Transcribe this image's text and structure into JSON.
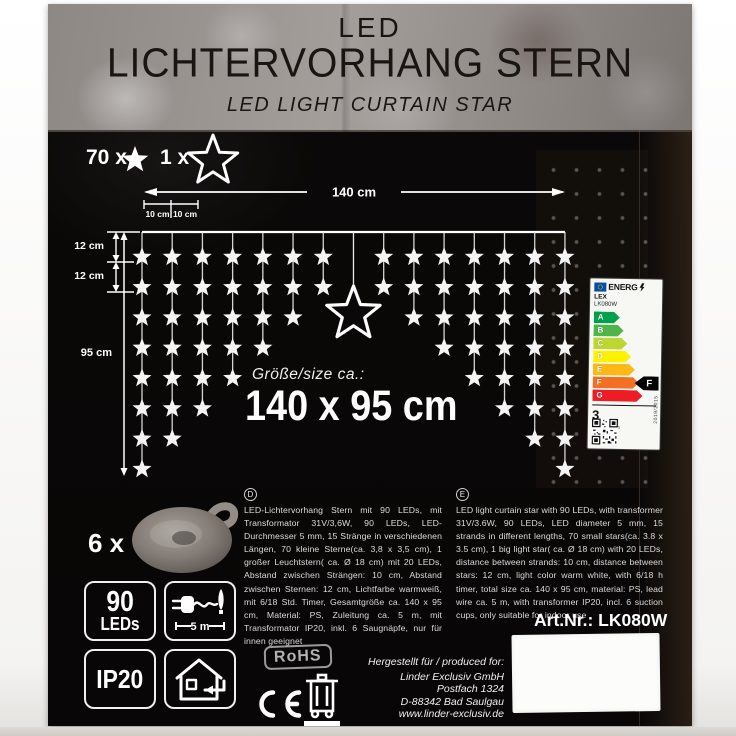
{
  "header": {
    "brand": "LED",
    "title": "LICHTERVORHANG STERN",
    "subtitle": "LED LIGHT CURTAIN STAR"
  },
  "counts": {
    "small_stars": "70 x",
    "big_star": "1 x"
  },
  "diagram": {
    "total_width_label": "140 cm",
    "strand_gap_label_1": "10 cm",
    "strand_gap_label_2": "10 cm",
    "first_gap_label": "12 cm",
    "star_gap_label": "12 cm",
    "total_height_label": "95 cm",
    "strand_star_counts": [
      8,
      7,
      6,
      5,
      4,
      3,
      2,
      0,
      2,
      3,
      4,
      5,
      6,
      7,
      8
    ],
    "big_star_strand_index": 7
  },
  "size_callout": {
    "label": "Größe/size ca.:",
    "value": "140 x 95 cm"
  },
  "energy_label": {
    "header": "ENERG",
    "brand": "LEX",
    "model": "LK080W",
    "classes": [
      {
        "letter": "A",
        "color": "#00a14b"
      },
      {
        "letter": "B",
        "color": "#4fb548"
      },
      {
        "letter": "C",
        "color": "#bed630"
      },
      {
        "letter": "D",
        "color": "#fff200"
      },
      {
        "letter": "E",
        "color": "#fcb814"
      },
      {
        "letter": "F",
        "color": "#f36f21"
      },
      {
        "letter": "G",
        "color": "#ee1c25"
      }
    ],
    "rating": "F",
    "rating_index": 5,
    "consumption_value": "3",
    "consumption_unit": "kWh/1000h",
    "side_text": "2019/2015"
  },
  "suction_cups": {
    "count": "6 x"
  },
  "description_de": {
    "marker": "D",
    "text": "LED-Lichtervorhang Stern mit 90 LEDs, mit Transformator 31V/3,6W, 90 LEDs, LED-Durchmesser 5 mm, 15 Stränge in verschiedenen Längen, 70 kleine Sterne(ca. 3,8 x 3,5 cm), 1 großer Leuchtstern( ca. Ø 18 cm) mit 20 LEDs, Abstand zwischen Strängen: 10 cm, Abstand zwischen Sternen: 12 cm, Lichtfarbe warmweiß, mit 6/18 Std. Timer, Gesamtgröße ca. 140 x 95 cm, Material: PS, Zuleitung ca. 5 m, mit Transformator IP20, inkl. 6 Saugnäpfe, nur für innen geeignet"
  },
  "description_en": {
    "marker": "E",
    "text": "LED light curtain star with 90 LEDs, with transformer 31V/3.6W, 90 LEDs, LED diameter 5 mm, 15 strands in different lengths, 70 small stars(ca. 3.8 x 3.5 cm), 1 big light star( ca. Ø 18 cm) with 20 LEDs, distance between strands: 10 cm, distance between stars: 12 cm, light color warm white, with 6/18 h timer, total size ca. 140 x 95 cm, material: PS, lead wire ca. 5 m, with transformer IP20, incl. 6 suction cups, only suitable for indoor use"
  },
  "badges": {
    "leds_value": "90",
    "leds_unit": "LEDs",
    "cable_length": "5 m",
    "ip_rating": "IP20"
  },
  "certifications": {
    "rohs": "RoHS"
  },
  "article": {
    "text": "Art.Nr.: LK080W"
  },
  "producer": {
    "intro": "Hergestellt für / produced for:",
    "lines": [
      "Linder Exclusiv GmbH",
      "Postfach 1324",
      "D-88342 Bad Saulgau",
      "www.linder-exclusiv.de"
    ]
  }
}
